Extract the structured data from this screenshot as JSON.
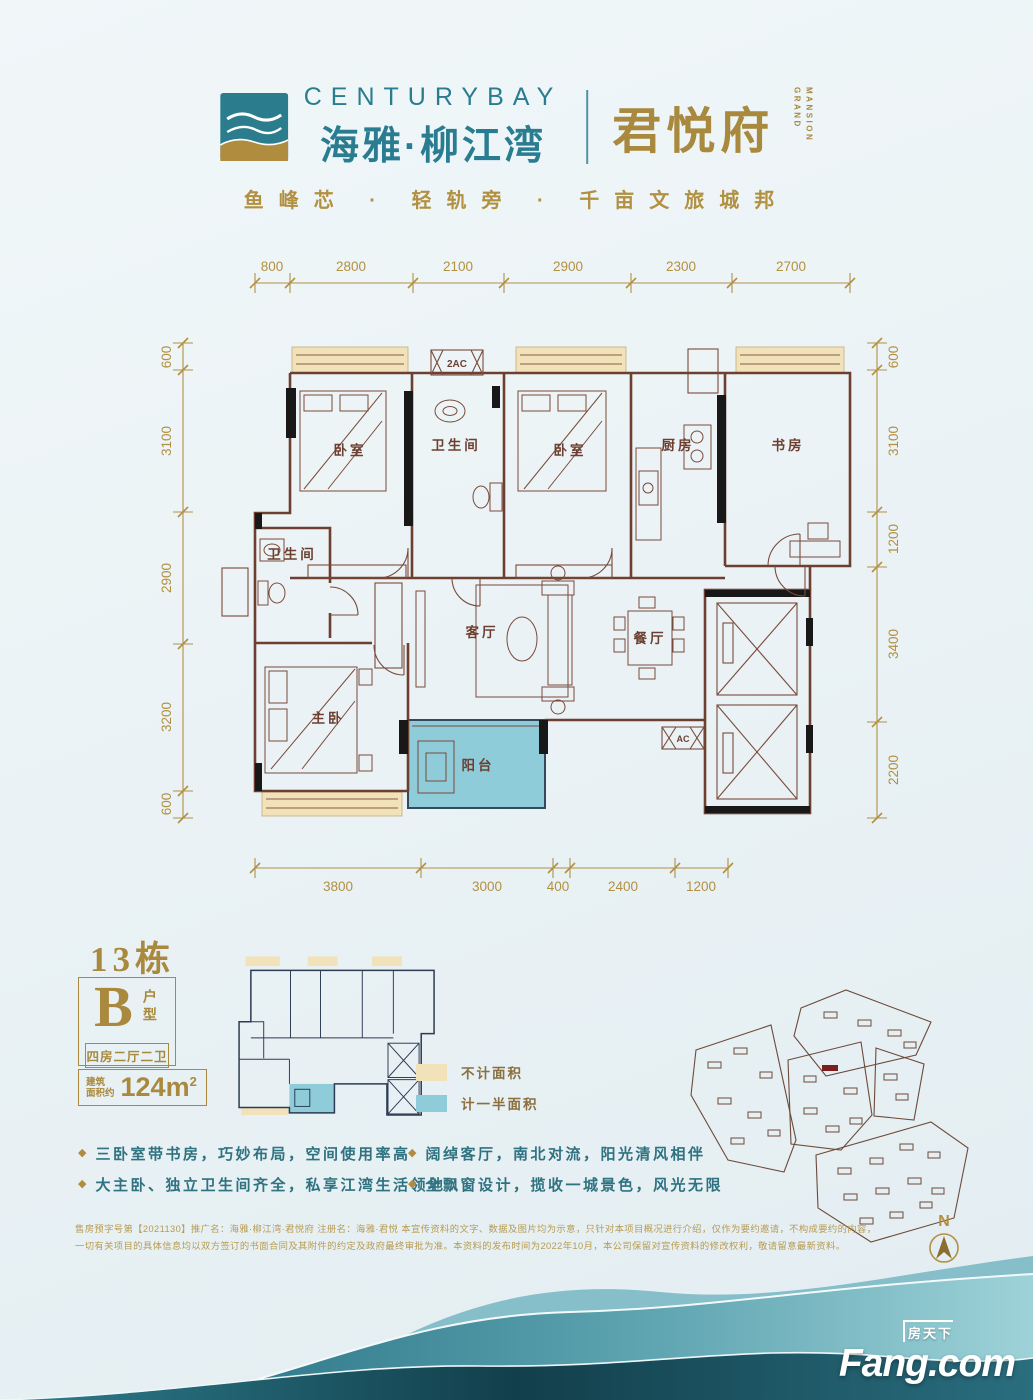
{
  "header": {
    "logo_brand_en": "CENTURYBAY",
    "logo_brand_cn": "海雅·柳江湾",
    "logo_name": "君悦府",
    "logo_sub_en_1": "GRAND",
    "logo_sub_en_2": "MANSION",
    "tagline": "鱼峰芯 · 轻轨旁 · 千亩文旅城邦"
  },
  "floor_plan": {
    "dims_top": [
      "800",
      "2800",
      "2100",
      "2900",
      "2300",
      "2700"
    ],
    "dims_left": [
      "600",
      "3100",
      "2900",
      "3200",
      "600"
    ],
    "dims_right": [
      "600",
      "3100",
      "1200",
      "3400",
      "2200"
    ],
    "dims_bottom": [
      "3800",
      "3000",
      "400",
      "2400",
      "1200"
    ],
    "rooms": {
      "bedroom1": "卧室",
      "bathroom1": "卫生间",
      "bedroom2": "卧室",
      "kitchen": "厨房",
      "study": "书房",
      "bathroom2": "卫生间",
      "living": "客厅",
      "dining": "餐厅",
      "master": "主卧",
      "balcony": "阳台"
    },
    "labels": {
      "ac_top": "2AC",
      "ac_unit": "AC"
    }
  },
  "unit_info": {
    "building": "13栋",
    "type_letter": "B",
    "type_suffix": "户型",
    "layout": "四房二厅二卫",
    "area_label_1": "建筑",
    "area_label_2": "面积约",
    "area_value": "124m",
    "area_sup": "2"
  },
  "legend": [
    {
      "label": "不计面积",
      "color": "#f1e2ba"
    },
    {
      "label": "计一半面积",
      "color": "#8fccd9"
    }
  ],
  "bullet_icon": "◆",
  "features": [
    "三卧室带书房，巧妙布局，空间使用率高",
    "大主卧、独立卫生间齐全，私享江湾生活领地",
    "阔绰客厅，南北对流，阳光清风相伴",
    "全飘窗设计，揽收一城景色，风光无限"
  ],
  "site_map": {
    "compass": "N"
  },
  "disclaimer": {
    "line1": "售房预字号第【2021130】推广名：海雅·柳江湾·君悦府 注册名：海雅·君悦 本宣传资料的文字、数据及图片均为示意，只针对本项目概况进行介绍，仅作为要约邀请，不构成要约的内容，",
    "line2": "一切有关项目的具体信息均以双方签订的书面合同及其附件的约定及政府最终审批为准。本资料的发布时间为2022年10月，本公司保留对宣传资料的修改权利，敬请留意最新资料。"
  },
  "footer": {
    "logo_cn": "房天下",
    "logo_en": "Fang.com"
  },
  "colors": {
    "brand_teal": "#2a7c90",
    "brand_gold": "#a8893d",
    "dim_gold": "#b29041",
    "wall_brown": "#6d3f30",
    "bay_tan": "#f1e2ba",
    "balcony_blue": "#8fccd9",
    "mini_navy": "#2c3b52",
    "feature_teal": "#2f7280",
    "highlight_red": "#7a1f1f",
    "wave_teal_dark": "#1d5f70"
  }
}
